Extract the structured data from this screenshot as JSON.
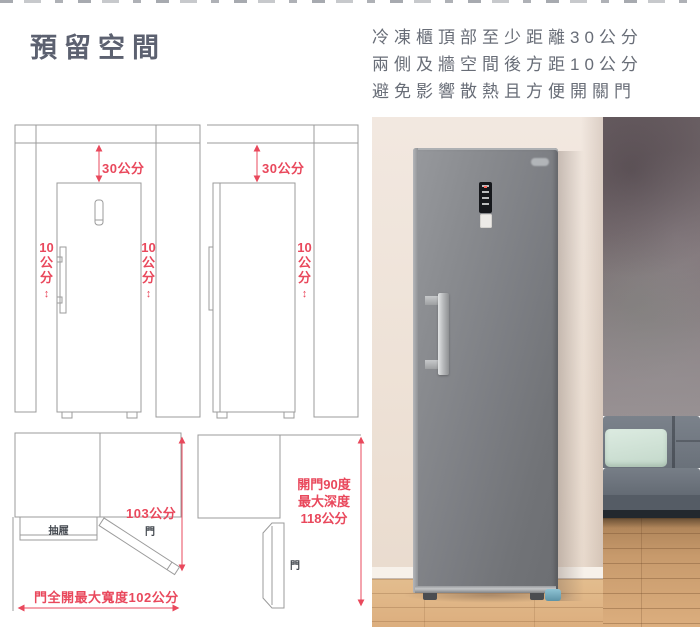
{
  "header": {
    "title": "預留空間",
    "note_lines": [
      "冷凍櫃頂部至少距離30公分",
      "兩側及牆空間後方距10公分",
      "避免影響散熱且方便開關門"
    ]
  },
  "icons": {
    "updown_arrow": "↕"
  },
  "diagrams": {
    "front_view": {
      "top_clearance": "30公分",
      "left_clearance": "10公分",
      "right_clearance": "10公分"
    },
    "side_view": {
      "top_clearance": "30公分",
      "back_clearance": "10公分"
    },
    "top_view_full_open": {
      "height_dim": "103公分",
      "door": "門",
      "drawer": "抽屜",
      "bottom_dim": "門全開最大寬度102公分"
    },
    "top_view_90": {
      "door": "門",
      "lines": [
        "開門90度",
        "最大深度",
        "118公分"
      ]
    }
  },
  "colors": {
    "dimension_red": "#e9485c",
    "diagram_line": "#9b9b9b",
    "title_text": "#5c6170",
    "wall_cream": "#eee2d7",
    "wall_concrete": "#7a6f72",
    "sofa_gray": "#747b84",
    "cushion_mint": "#cfe0d5",
    "floor_wood": "#d8ab7c",
    "freezer_body": "#7d7f84"
  }
}
